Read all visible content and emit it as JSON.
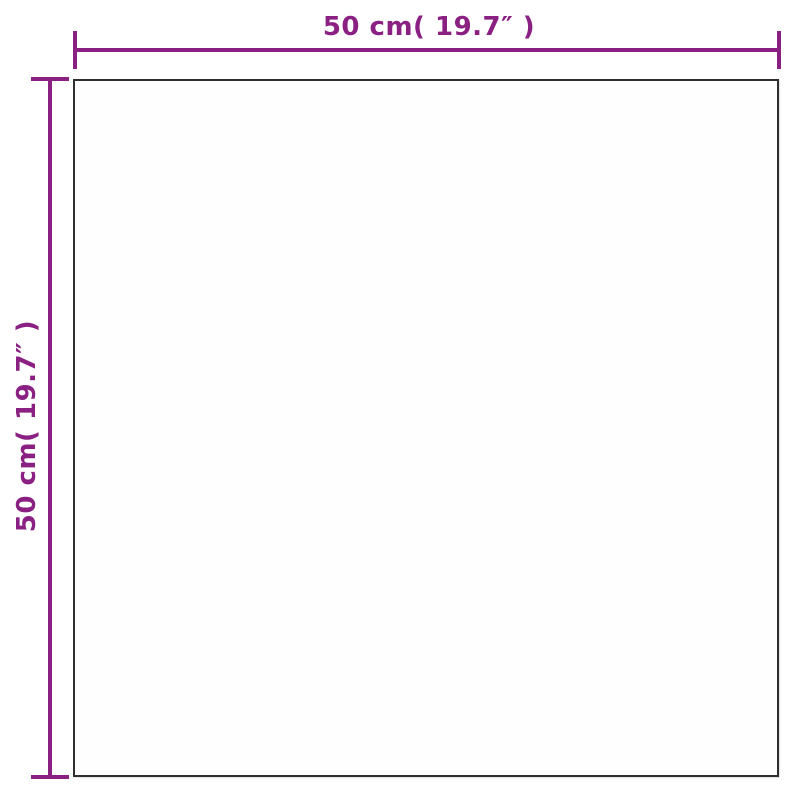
{
  "diagram": {
    "type": "product-dimension-diagram",
    "product": "square panel (mirror) front view",
    "top_dimension": {
      "label": "50 cm( 19.7″ )",
      "value_cm": 50,
      "value_inch": 19.7
    },
    "left_dimension": {
      "label": "50 cm( 19.7″ )",
      "value_cm": 50,
      "value_inch": 19.7
    },
    "colors": {
      "dimension_accent": "#8a2082",
      "outline": "#2f2f2f",
      "background": "#ffffff"
    }
  }
}
